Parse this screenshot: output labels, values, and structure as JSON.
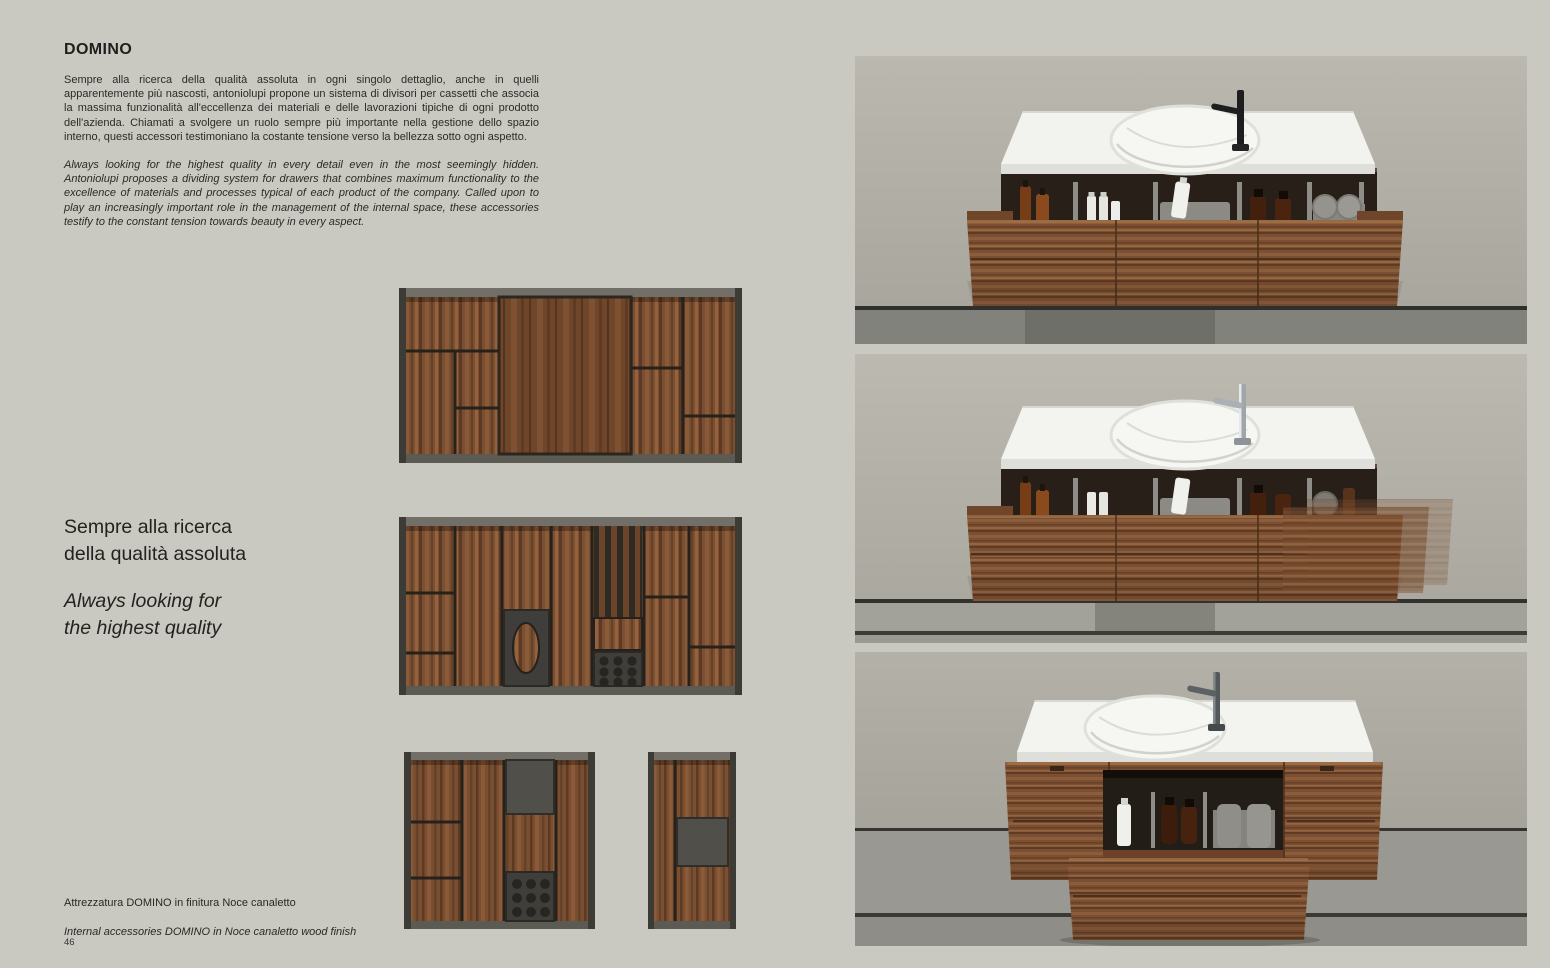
{
  "page": {
    "left_page_number": "46",
    "right_page_number": "47",
    "background_color": "#cac9c1"
  },
  "left": {
    "title": "DOMINO",
    "intro_it": "Sempre alla ricerca della qualità assoluta in ogni singolo dettaglio, anche in quelli apparentemente più nascosti, antoniolupi propone un sistema di divisori per cassetti che associa la massima funzionalità all'eccellenza dei materiali e delle lavorazioni tipiche di ogni prodotto dell'azienda. Chiamati a svolgere un ruolo sempre più importante nella gestione dello spazio interno, questi accessori testimoniano la costante tensione verso la bellezza sotto ogni aspetto.",
    "intro_en": "Always looking for the highest quality in every detail even in the most seemingly hidden. Antoniolupi proposes a dividing system for drawers that combines maximum functionality to the excellence of materials and processes typical of each product of the company. Called upon to play an increasingly important role in the management of the internal space, these accessories testify to the constant tension towards beauty in every aspect.",
    "pull_quote_it": [
      "Sempre alla ricerca",
      "della qualità assoluta"
    ],
    "pull_quote_en": [
      "Always looking for",
      "the highest quality"
    ],
    "caption_it": "Attrezzatura DOMINO in finitura Noce canaletto",
    "caption_en": "Internal accessories DOMINO in Noce canaletto wood finish",
    "images": [
      {
        "name": "organizer-wide-top",
        "alt": "DOMINO drawer divider tray, walnut, wide layout"
      },
      {
        "name": "organizer-wide-accessories",
        "alt": "DOMINO drawer divider tray with oval plate, bottle holder and slats"
      },
      {
        "name": "organizer-square",
        "alt": "DOMINO square drawer divider tray with tray and bottle holder"
      },
      {
        "name": "organizer-narrow",
        "alt": "DOMINO narrow drawer divider tray with plate"
      }
    ]
  },
  "right": {
    "photos": [
      {
        "name": "vanity-open-drawer",
        "alt": "Wall-hung walnut vanity, white top with round basin, black tap, open drawer with DOMINO accessories"
      },
      {
        "name": "vanity-drawer-closing",
        "alt": "Wall-hung walnut vanity, chrome tap, drawer shown closing in motion"
      },
      {
        "name": "vanity-inner-drawer",
        "alt": "Wall-hung walnut vanity, gunmetal tap, central inner drawer pulled out"
      }
    ]
  },
  "colors": {
    "wood_mid": "#7b4f31",
    "wood_dark": "#5e3b24",
    "wood_light": "#95653f",
    "frame_dark": "#45443f",
    "wall_photo": "#b3b0a7",
    "floor_photo": "#84847e",
    "countertop": "#f2f2ef",
    "text": "#282826"
  }
}
